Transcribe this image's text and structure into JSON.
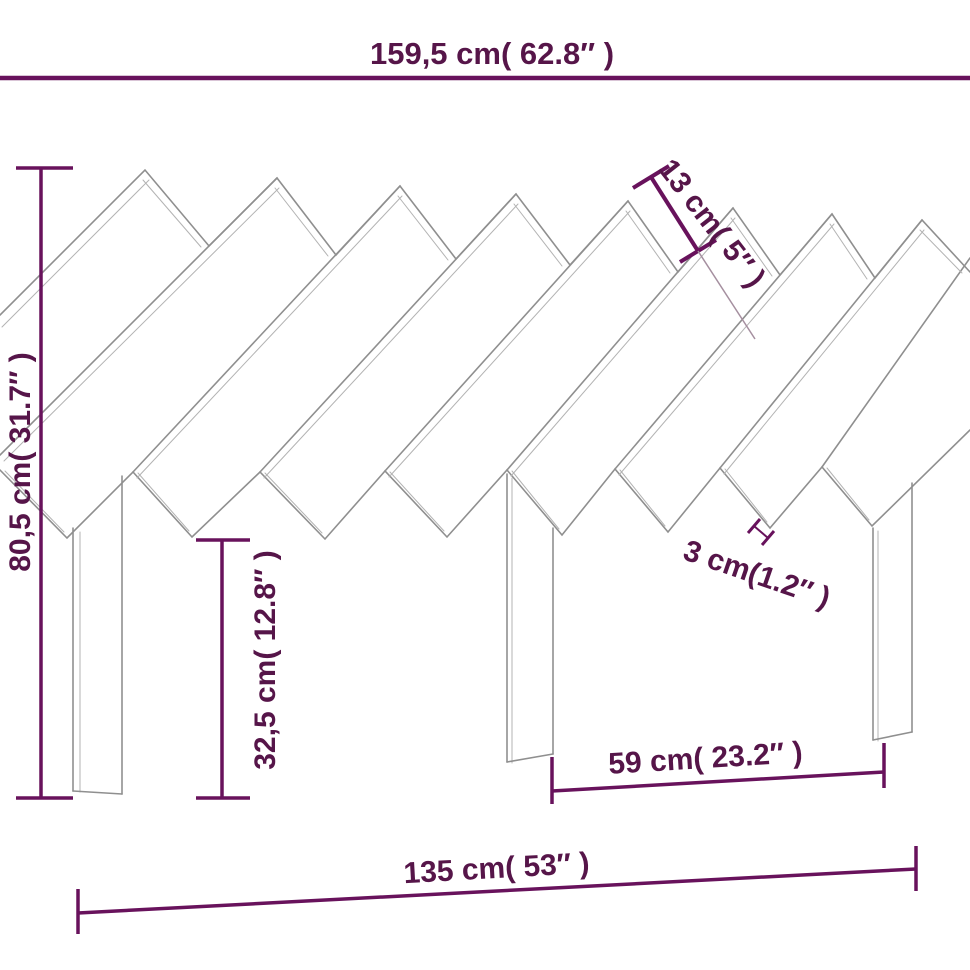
{
  "diagram": {
    "type": "furniture-dimension-drawing",
    "subject": "slatted headboard with legs",
    "labels": {
      "top_width": "159,5 cm( 62.8″ )",
      "left_height": "80,5 cm( 31.7″ )",
      "leg_height": "32,5 cm( 12.8″ )",
      "slat_width": "13 cm( 5″ )",
      "slat_thickness": "3 cm(1.2″ )",
      "leg_spacing": "59 cm( 23.2″ )",
      "base_width": "135 cm( 53″ )"
    },
    "colors": {
      "dimension_text": "#561549",
      "dimension_line": "#68125c",
      "drawing_outline": "#8f8f8f",
      "drawing_thin_edge": "#b3b3b3",
      "background": "#ffffff"
    }
  }
}
